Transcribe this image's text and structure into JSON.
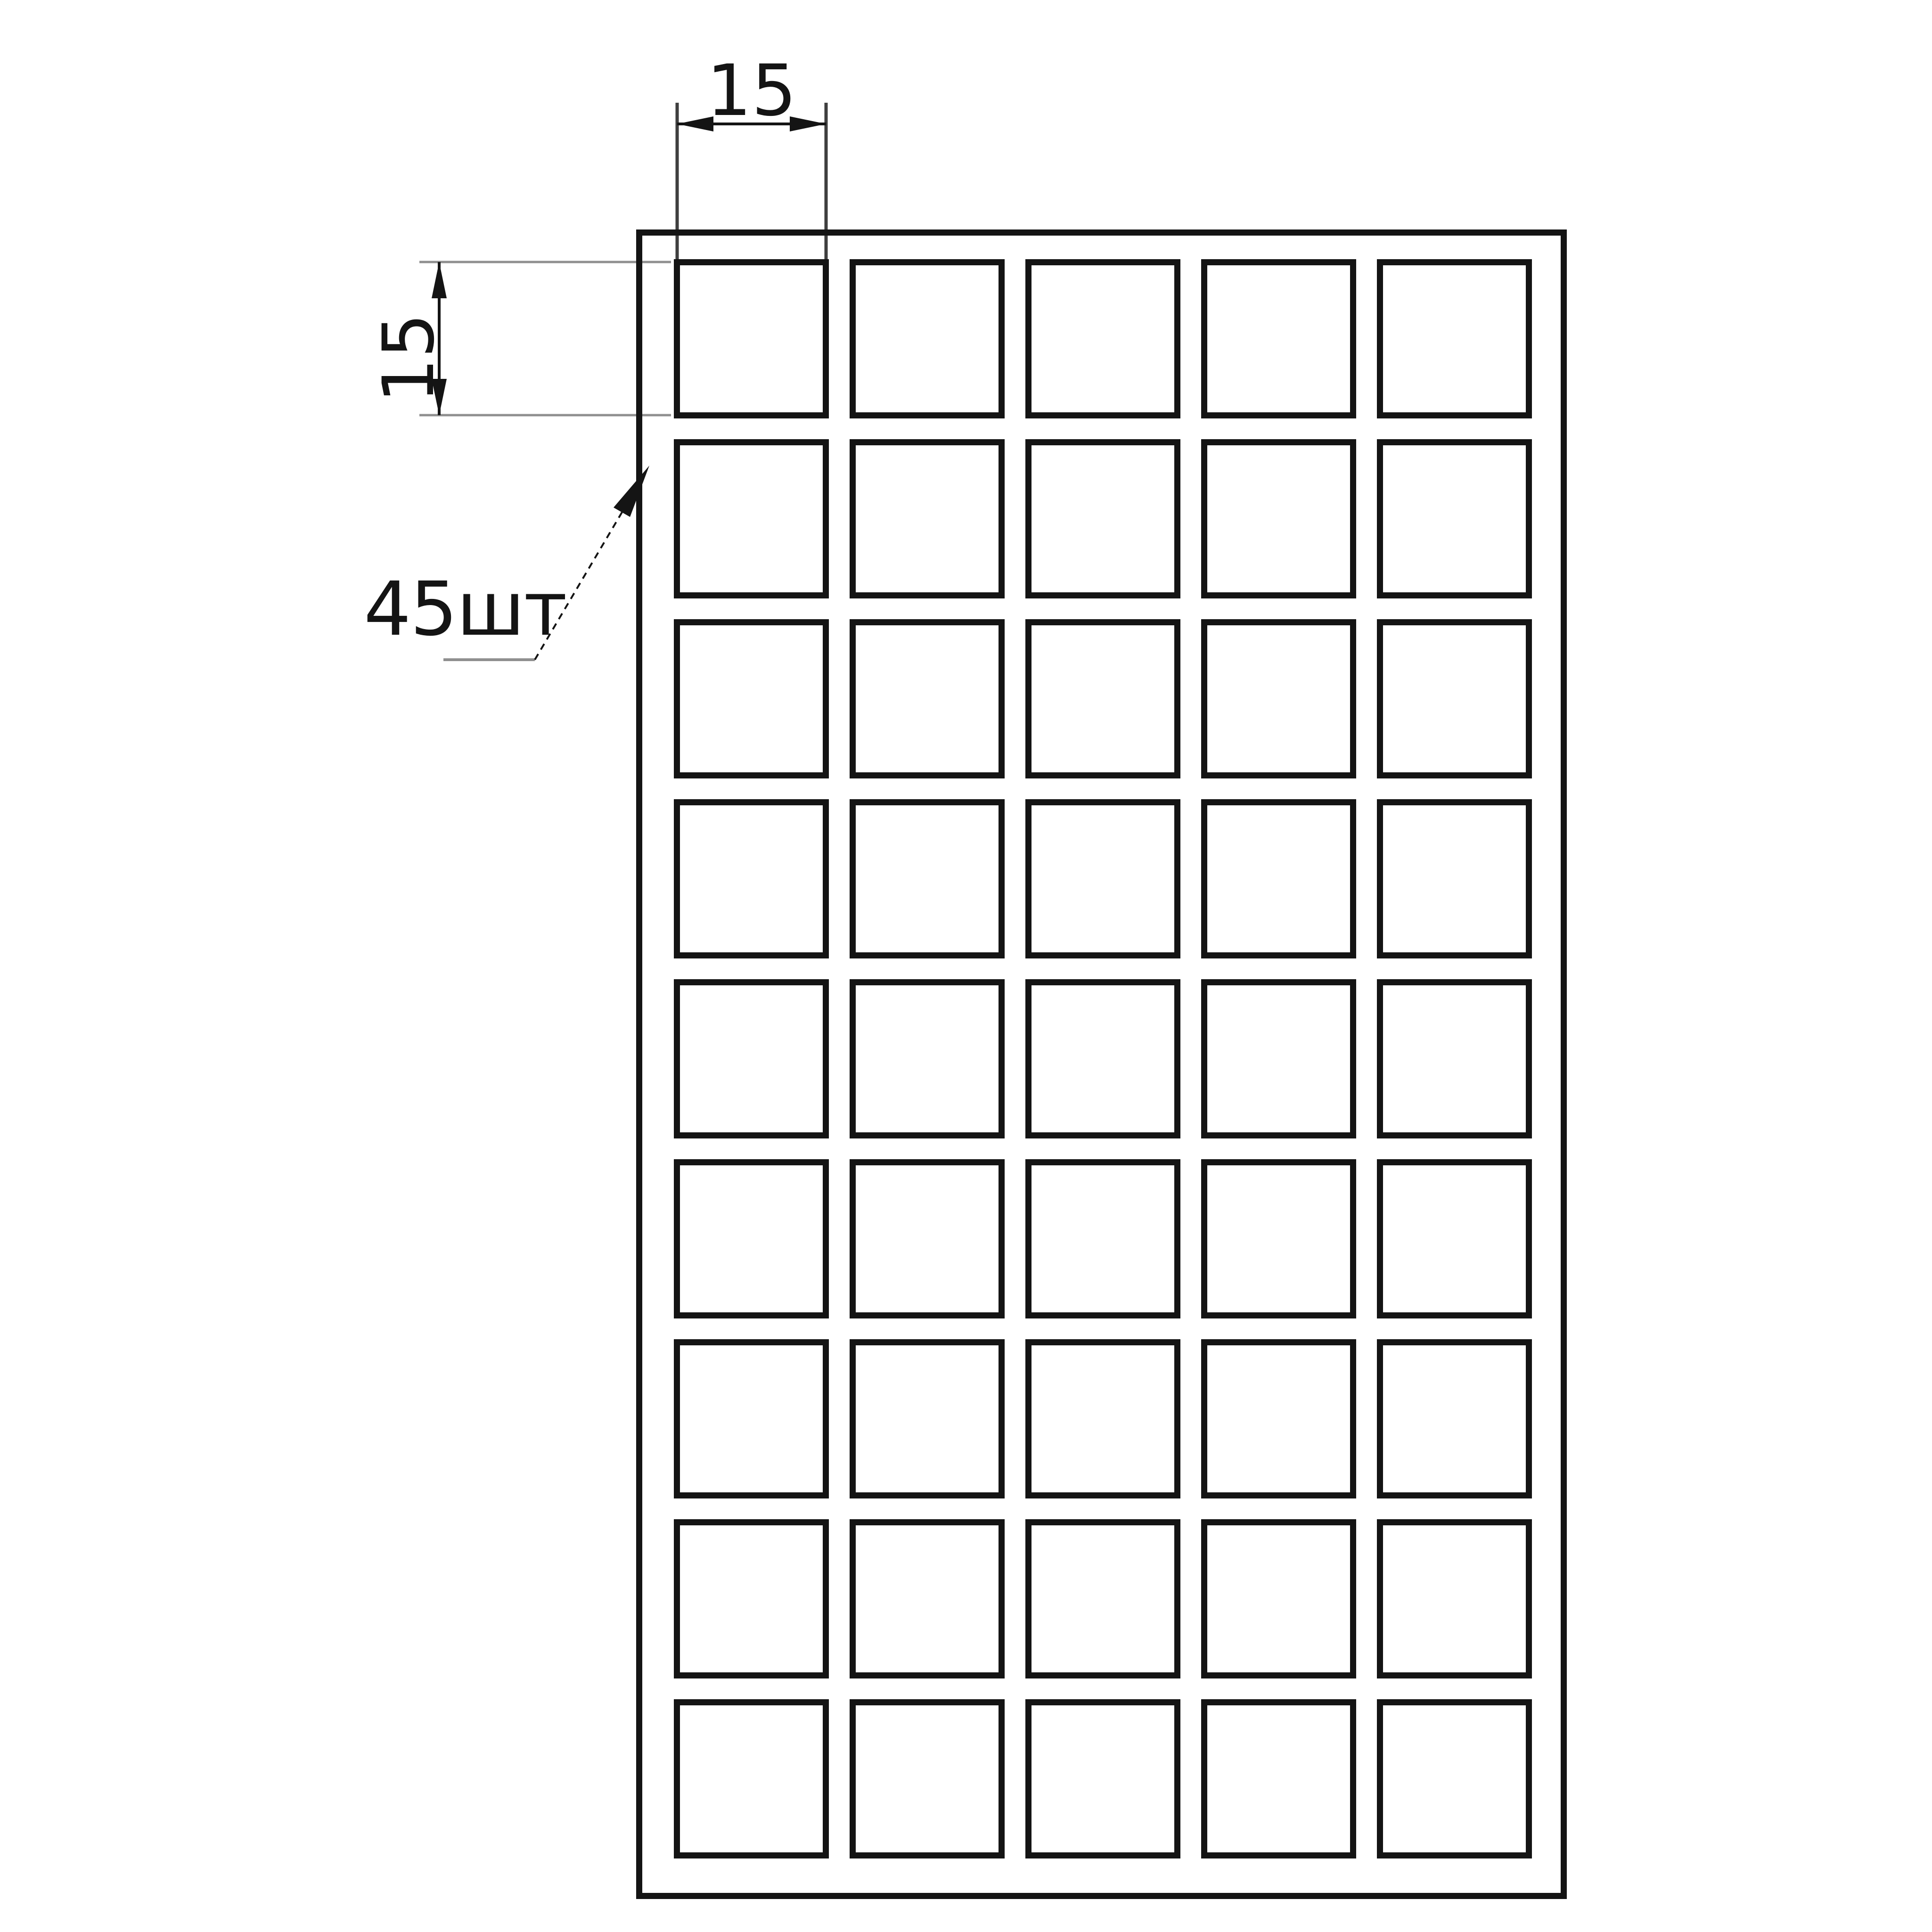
{
  "labels": {
    "top_dimension": "15",
    "left_dimension": "15",
    "quantity_callout": "45шт"
  },
  "grid": {
    "rows": 9,
    "columns": 5,
    "cell_count": 45
  },
  "colors": {
    "line": "#141414",
    "extension_gray": "#8f8f8f",
    "extension_dark": "#3f3f3f",
    "background": "#ffffff"
  }
}
